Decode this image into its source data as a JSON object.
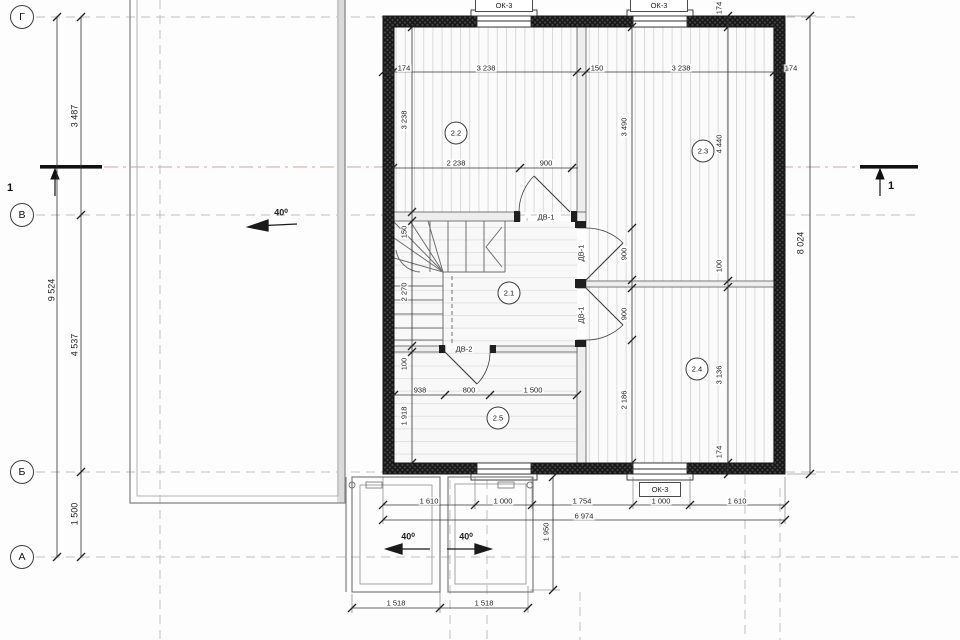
{
  "title": "Floor plan (level 2) with section 1-1",
  "axes": {
    "top": "Г",
    "middle": "В",
    "lower": "Б",
    "bottom": "А"
  },
  "section_markers": {
    "left": "1",
    "right": "1"
  },
  "window_labels": {
    "top_left": "ОК-3",
    "top_right": "ОК-3",
    "bottom": "ОК-3"
  },
  "door_labels": {
    "hall_top": "ДВ-1",
    "right_upper": "ДВ-1",
    "right_lower": "ДВ-1",
    "bottom": "ДВ-2"
  },
  "room_labels": {
    "hall": "2.1",
    "top_left": "2.2",
    "top_right": "2.3",
    "bottom_right": "2.4",
    "bottom_center": "2.5"
  },
  "roof_slope": {
    "main": "40⁰",
    "porch_left": "40⁰",
    "porch_right": "40⁰"
  },
  "dims": {
    "left_outer": "9 524",
    "left_segments": [
      "3 487",
      "4 537",
      "1 500"
    ],
    "top": [
      "174",
      "3 238",
      "150",
      "3 238",
      "174"
    ],
    "upper_mid": [
      "2 238",
      "900"
    ],
    "inner_left": [
      "3 238",
      "150",
      "2 270",
      "100",
      "1 918"
    ],
    "inner_mid": [
      "3 490",
      "900",
      "900",
      "2 186"
    ],
    "inner_right": [
      "174",
      "4 440",
      "100",
      "3 136",
      "174"
    ],
    "right_outer": "8 024",
    "mid": [
      "938",
      "800",
      "1 500"
    ],
    "bottom": [
      "1 610",
      "1 000",
      "1 754",
      "1 000",
      "1 610"
    ],
    "bottom_total": "6 974",
    "porch": [
      "1 518",
      "1 518"
    ],
    "porch_height": "1 950"
  }
}
